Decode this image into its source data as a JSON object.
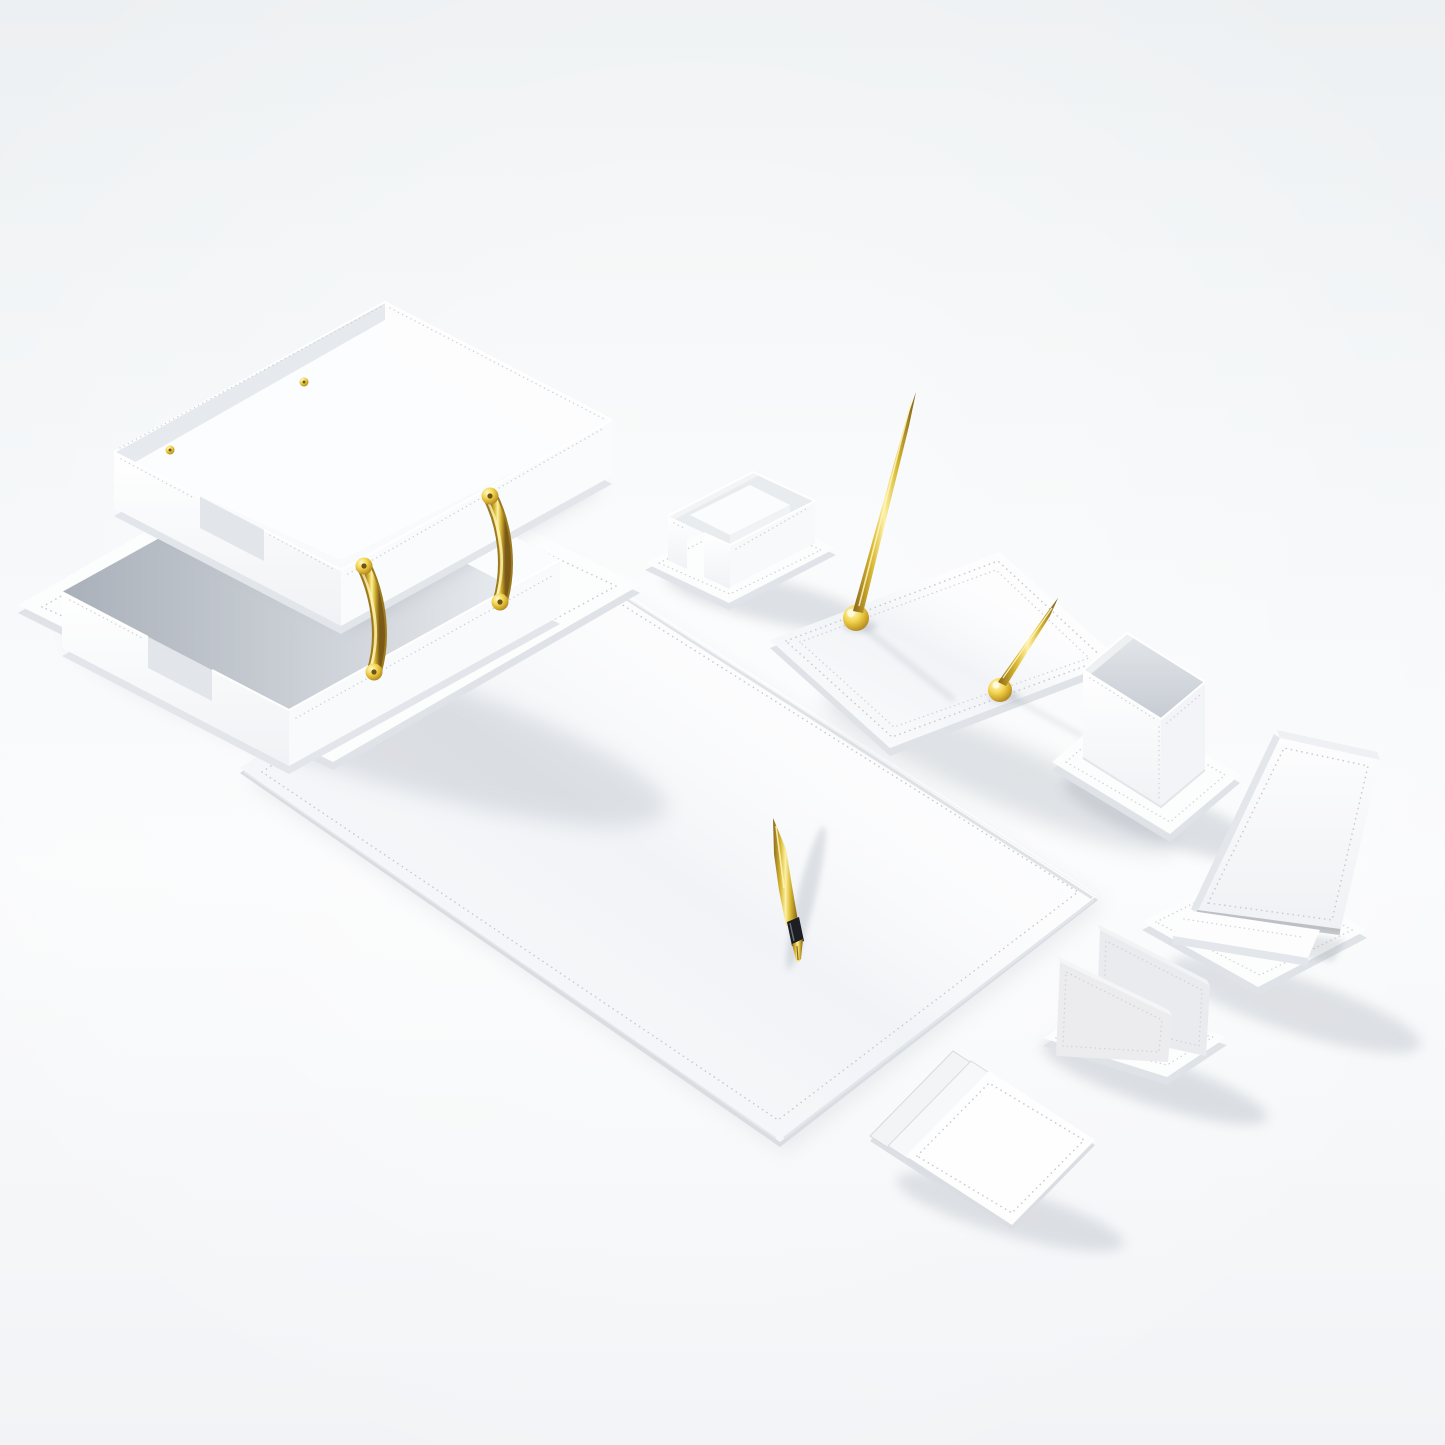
{
  "scene": {
    "type": "product-photograph",
    "subject": "White leather executive desk organizer set with gold metal accents",
    "background": {
      "corner": "#eef1f3",
      "center": "#fafbfc",
      "bottom": "#f2f4f6"
    },
    "palette": {
      "leather_white": "#fdfdfe",
      "leather_soft": "#f7f9fb",
      "leather_edge": "#e2e5ea",
      "leather_inner": "#eceef1",
      "lining_gray": "#d9dde2",
      "stitch": "#c6cad1",
      "shadow": "#99a1ac",
      "gold": "#d9b832",
      "gold_light": "#fdf1a7",
      "gold_dark": "#8a671c",
      "pen_grip": "#1c1e23"
    },
    "items": [
      {
        "id": "document-tray",
        "label": "Double letter tray with curved gold handles",
        "position": "upper-left"
      },
      {
        "id": "memo-holder",
        "label": "Memo and business card holder on stitched base",
        "position": "top-center"
      },
      {
        "id": "pen-stand",
        "label": "Pen stand base with two standing gold pens",
        "position": "upper-right-center"
      },
      {
        "id": "pen-cup",
        "label": "Square pen cup on stitched base",
        "position": "right"
      },
      {
        "id": "phone-stand",
        "label": "Leather phone stand with angled back rest",
        "position": "right"
      },
      {
        "id": "desk-pad",
        "label": "Large leather desk pad blotter",
        "position": "center"
      },
      {
        "id": "gold-pen",
        "label": "Gold fountain pen resting on desk pad",
        "position": "center"
      },
      {
        "id": "letter-holder",
        "label": "Two-panel letter holder",
        "position": "lower-right"
      },
      {
        "id": "coaster-set",
        "label": "Stack of three square leather coasters",
        "position": "bottom-center"
      }
    ]
  }
}
